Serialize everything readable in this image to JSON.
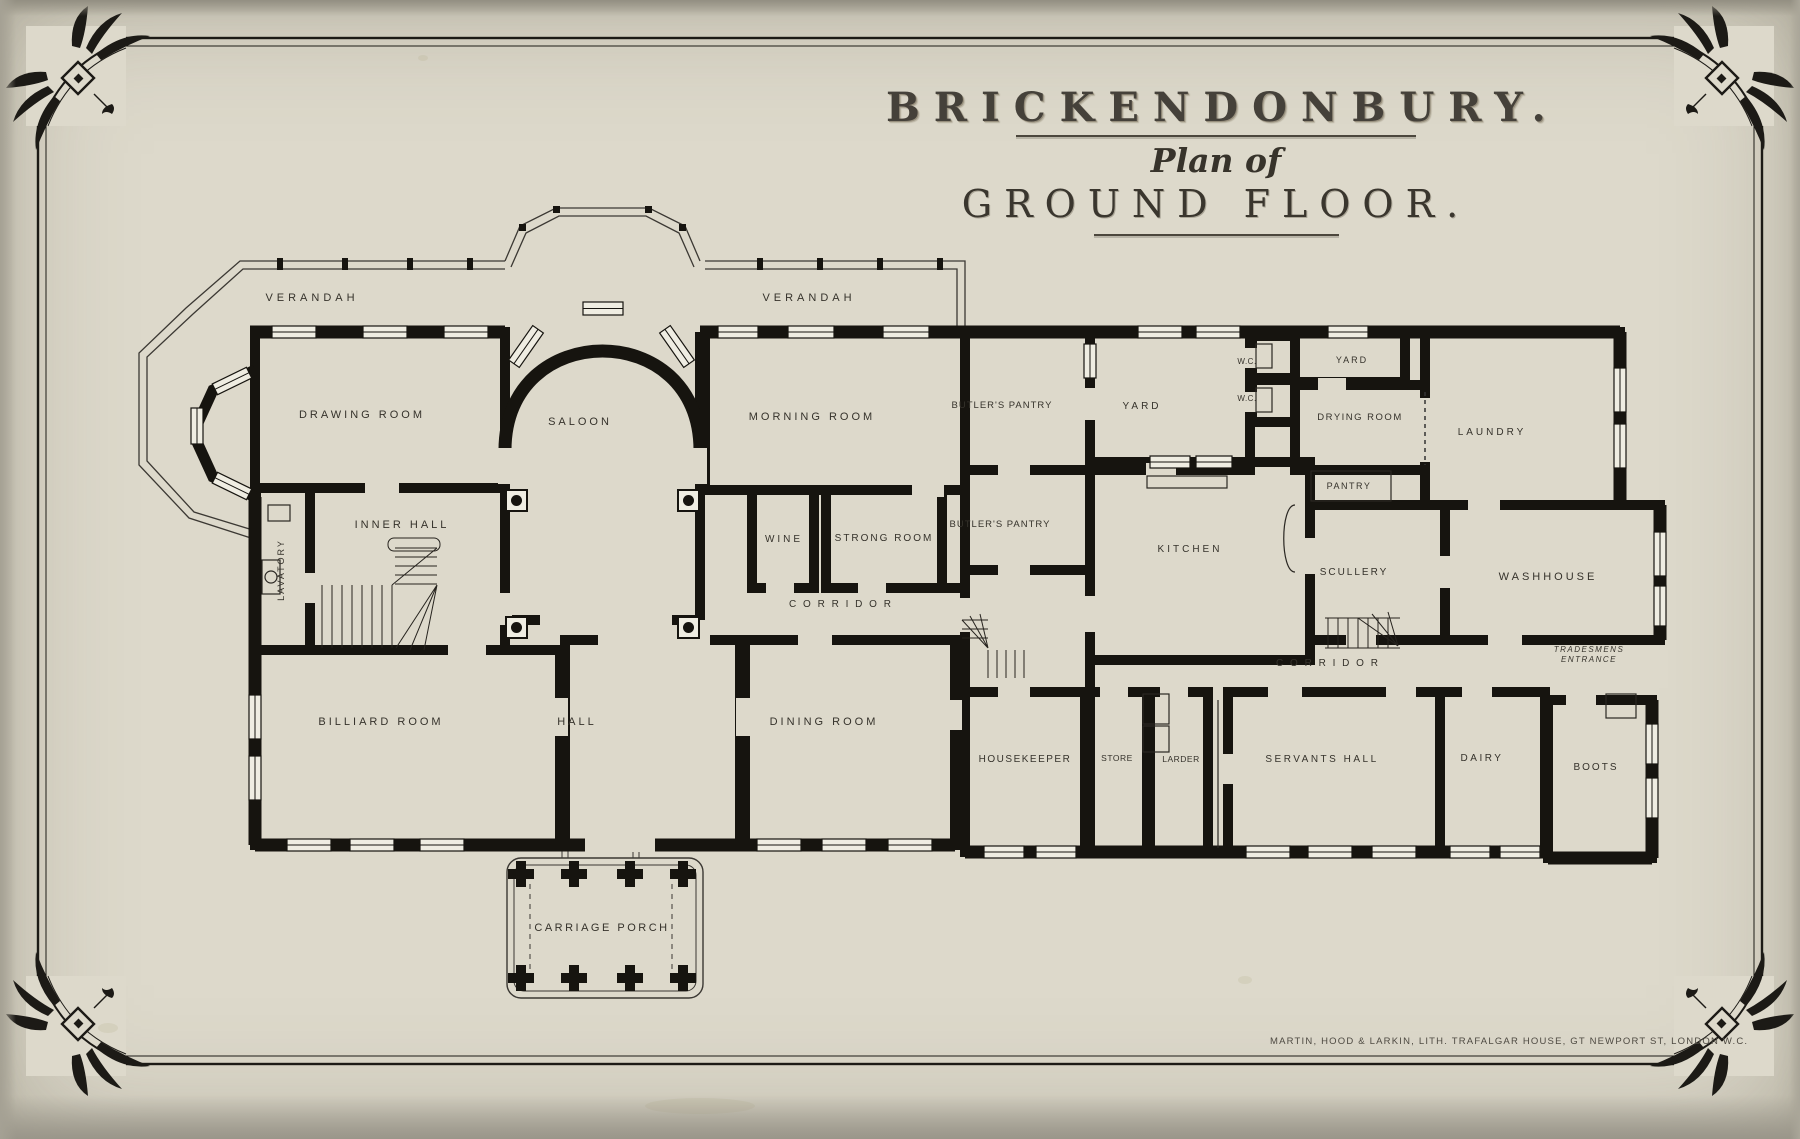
{
  "title": {
    "estate": "BRICKENDONBURY.",
    "subtitle": "Plan of",
    "floor": "GROUND FLOOR."
  },
  "imprint": "MARTIN, HOOD & LARKIN, LITH. TRAFALGAR HOUSE, GT NEWPORT ST, LONDON W.C.",
  "colors": {
    "paper": "#ddd9cb",
    "window_fill": "#efede2",
    "ink": "#16140f",
    "label_ink": "#35322b"
  },
  "rooms": [
    {
      "id": "verandah-west",
      "label": "VERANDAH",
      "x": 312,
      "y": 301,
      "fs": 11,
      "ls": 4
    },
    {
      "id": "verandah-east",
      "label": "VERANDAH",
      "x": 809,
      "y": 301,
      "fs": 11,
      "ls": 4
    },
    {
      "id": "drawing-room",
      "label": "DRAWING  ROOM",
      "x": 362,
      "y": 418,
      "fs": 11,
      "ls": 3
    },
    {
      "id": "saloon",
      "label": "SALOON",
      "x": 580,
      "y": 425,
      "fs": 11,
      "ls": 3
    },
    {
      "id": "morning-room",
      "label": "MORNING  ROOM",
      "x": 812,
      "y": 420,
      "fs": 11,
      "ls": 3
    },
    {
      "id": "inner-hall",
      "label": "INNER HALL",
      "x": 402,
      "y": 528,
      "fs": 11,
      "ls": 3
    },
    {
      "id": "lavatory",
      "label": "LAVATORY",
      "x": 284,
      "y": 570,
      "fs": 9,
      "ls": 2,
      "rot": -90
    },
    {
      "id": "wine",
      "label": "WINE",
      "x": 784,
      "y": 542,
      "fs": 10,
      "ls": 3
    },
    {
      "id": "strong-room",
      "label": "STRONG ROOM",
      "x": 884,
      "y": 541,
      "fs": 10,
      "ls": 2
    },
    {
      "id": "corridor-west",
      "label": "C O R R I D O R",
      "x": 841,
      "y": 607,
      "fs": 10,
      "ls": 2
    },
    {
      "id": "billiard-room",
      "label": "BILLIARD  ROOM",
      "x": 381,
      "y": 725,
      "fs": 11,
      "ls": 3
    },
    {
      "id": "hall",
      "label": "HALL",
      "x": 577,
      "y": 725,
      "fs": 11,
      "ls": 3
    },
    {
      "id": "dining-room",
      "label": "DINING  ROOM",
      "x": 824,
      "y": 725,
      "fs": 11,
      "ls": 3
    },
    {
      "id": "carriage-porch",
      "label": "CARRIAGE  PORCH",
      "x": 602,
      "y": 931,
      "fs": 11,
      "ls": 2.5
    },
    {
      "id": "butlers-pantry-north",
      "label": "BUTLER'S  PANTRY",
      "x": 1002,
      "y": 408,
      "fs": 9.5,
      "ls": 1
    },
    {
      "id": "yard",
      "label": "YARD",
      "x": 1142,
      "y": 409,
      "fs": 10,
      "ls": 3
    },
    {
      "id": "wc-north",
      "label": "W.C.",
      "x": 1247,
      "y": 364,
      "fs": 8,
      "ls": 0.5
    },
    {
      "id": "wc-south",
      "label": "W.C.",
      "x": 1247,
      "y": 401,
      "fs": 8,
      "ls": 0.5
    },
    {
      "id": "yard-small",
      "label": "YARD",
      "x": 1352,
      "y": 363,
      "fs": 9,
      "ls": 2
    },
    {
      "id": "drying-room",
      "label": "DRYING ROOM",
      "x": 1360,
      "y": 420,
      "fs": 9.5,
      "ls": 1.5
    },
    {
      "id": "laundry",
      "label": "LAUNDRY",
      "x": 1492,
      "y": 435,
      "fs": 10,
      "ls": 3
    },
    {
      "id": "pantry",
      "label": "PANTRY",
      "x": 1349,
      "y": 489,
      "fs": 9,
      "ls": 1.5
    },
    {
      "id": "butlers-pantry-south",
      "label": "BUTLER'S PANTRY",
      "x": 1000,
      "y": 527,
      "fs": 9.5,
      "ls": 1
    },
    {
      "id": "kitchen",
      "label": "KITCHEN",
      "x": 1190,
      "y": 552,
      "fs": 10,
      "ls": 3
    },
    {
      "id": "scullery",
      "label": "SCULLERY",
      "x": 1354,
      "y": 575,
      "fs": 10,
      "ls": 2
    },
    {
      "id": "washhouse",
      "label": "WASHHOUSE",
      "x": 1548,
      "y": 580,
      "fs": 11,
      "ls": 3
    },
    {
      "id": "corridor-east",
      "label": "C O R R I D O R",
      "x": 1328,
      "y": 666,
      "fs": 10,
      "ls": 2
    },
    {
      "id": "tradesmens-entrance",
      "label": "TRADESMENS\nENTRANCE",
      "x": 1589,
      "y": 652,
      "fs": 8,
      "ls": 1.5,
      "italic": true
    },
    {
      "id": "housekeeper",
      "label": "HOUSEKEEPER",
      "x": 1025,
      "y": 762,
      "fs": 10,
      "ls": 1.5
    },
    {
      "id": "store",
      "label": "STORE",
      "x": 1117,
      "y": 761,
      "fs": 8.5,
      "ls": 0.5
    },
    {
      "id": "larder",
      "label": "LARDER",
      "x": 1181,
      "y": 762,
      "fs": 8.5,
      "ls": 0.5
    },
    {
      "id": "servants-hall",
      "label": "SERVANTS  HALL",
      "x": 1322,
      "y": 762,
      "fs": 10,
      "ls": 2.5
    },
    {
      "id": "dairy",
      "label": "DAIRY",
      "x": 1482,
      "y": 761,
      "fs": 10,
      "ls": 2.5
    },
    {
      "id": "boots",
      "label": "BOOTS",
      "x": 1596,
      "y": 770,
      "fs": 10,
      "ls": 2
    }
  ]
}
